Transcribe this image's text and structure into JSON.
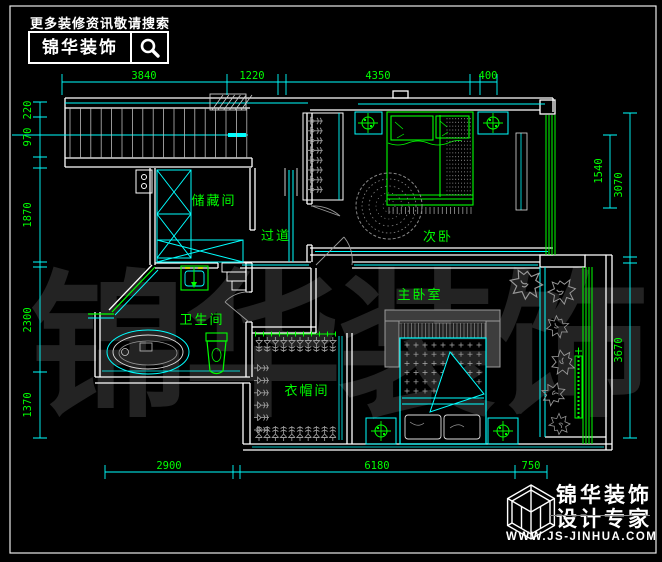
{
  "header": {
    "tagline": "更多装修资讯敬请搜索",
    "brand": "锦华装饰"
  },
  "watermark": "锦华装饰",
  "rooms": {
    "storage": "储藏间",
    "corridor": "过道",
    "second_bedroom": "次卧",
    "bathroom": "卫生间",
    "master_bedroom": "主卧室",
    "cloakroom": "衣帽间"
  },
  "dimensions": {
    "top": [
      "3840",
      "1220",
      "4350",
      "400"
    ],
    "left": [
      "220",
      "970",
      "1870",
      "2300",
      "1370"
    ],
    "right_outer": [
      "3070",
      "3670"
    ],
    "right_inner": "1540",
    "bottom": [
      "2900",
      "6180",
      "750"
    ]
  },
  "footer": {
    "brand": "锦华装饰",
    "subtitle": "设计专家",
    "website": "WWW.JS-JINHUA.COM"
  },
  "colors": {
    "background": "#000000",
    "wall_line": "#ffffff",
    "accent_line": "#00ffff",
    "furniture_line": "#00ff00",
    "dim_text": "#00ff00",
    "soft_gray": "#999999",
    "faucet_accent": "#ffff00"
  }
}
